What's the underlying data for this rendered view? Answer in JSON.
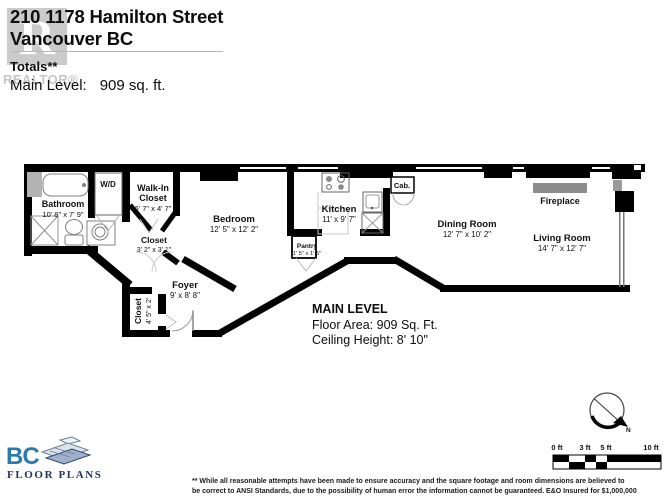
{
  "header": {
    "address_line1": "210 1178 Hamilton Street",
    "address_line2": "Vancouver BC",
    "totals": "Totals**",
    "main_level_label": "Main Level:",
    "main_level_value": "909  sq. ft.",
    "watermark_letter": "R",
    "watermark_text": "REALTOR®"
  },
  "rooms": {
    "bathroom": {
      "name": "Bathroom",
      "dims": "10' 8\" x 7' 9\""
    },
    "washer_dryer": {
      "name": "W/D"
    },
    "walk_in_closet": {
      "name_line1": "Walk-In",
      "name_line2": "Closet",
      "dims": "6' 7\" x 4' 7\""
    },
    "closet_hall": {
      "name": "Closet",
      "dims": "3' 2\" x 3' 1\""
    },
    "bedroom": {
      "name": "Bedroom",
      "dims": "12' 5\" x 12' 2\""
    },
    "kitchen": {
      "name": "Kitchen",
      "dims": "11' x 9' 7\""
    },
    "pantry": {
      "name": "Pantry",
      "dims": "1' 5\" x 1' 5\""
    },
    "cabinet": {
      "name": "Cab."
    },
    "dining_room": {
      "name": "Dining Room",
      "dims": "12' 7\" x 10' 2\""
    },
    "fireplace": {
      "name": "Fireplace"
    },
    "living_room": {
      "name": "Living Room",
      "dims": "14' 7\" x 12' 7\""
    },
    "foyer": {
      "name": "Foyer",
      "dims": "9' x 8' 8\""
    },
    "closet_foyer": {
      "name": "Closet",
      "dims": "4' 5\" x 2'"
    }
  },
  "summary": {
    "title": "MAIN LEVEL",
    "floor_area": "Floor Area: 909 Sq. Ft.",
    "ceiling_height": "Ceiling Height: 8' 10\""
  },
  "scale_bar": {
    "labels": [
      "0 ft",
      "3 ft",
      "5 ft",
      "10 ft"
    ]
  },
  "compass": {
    "north": "N"
  },
  "footer": {
    "bc": "BC",
    "floor_plans": "FLOOR PLANS",
    "disclaimer_line1": "** While all reasonable attempts have been made to ensure accuracy and the square footage and room dimensions are believed to",
    "disclaimer_line2": "be correct to ANSI Standards, due to the possibility of human error the information cannot be guaranteed. E&O Insured for $1,000,000"
  },
  "colors": {
    "wall": "#000000",
    "fixture_gray": "#808080",
    "fireplace_gray": "#8c8c8c",
    "logo_blue": "#2b79ad",
    "logo_navy": "#23355f",
    "watermark_gray": "#cbcbcb"
  }
}
